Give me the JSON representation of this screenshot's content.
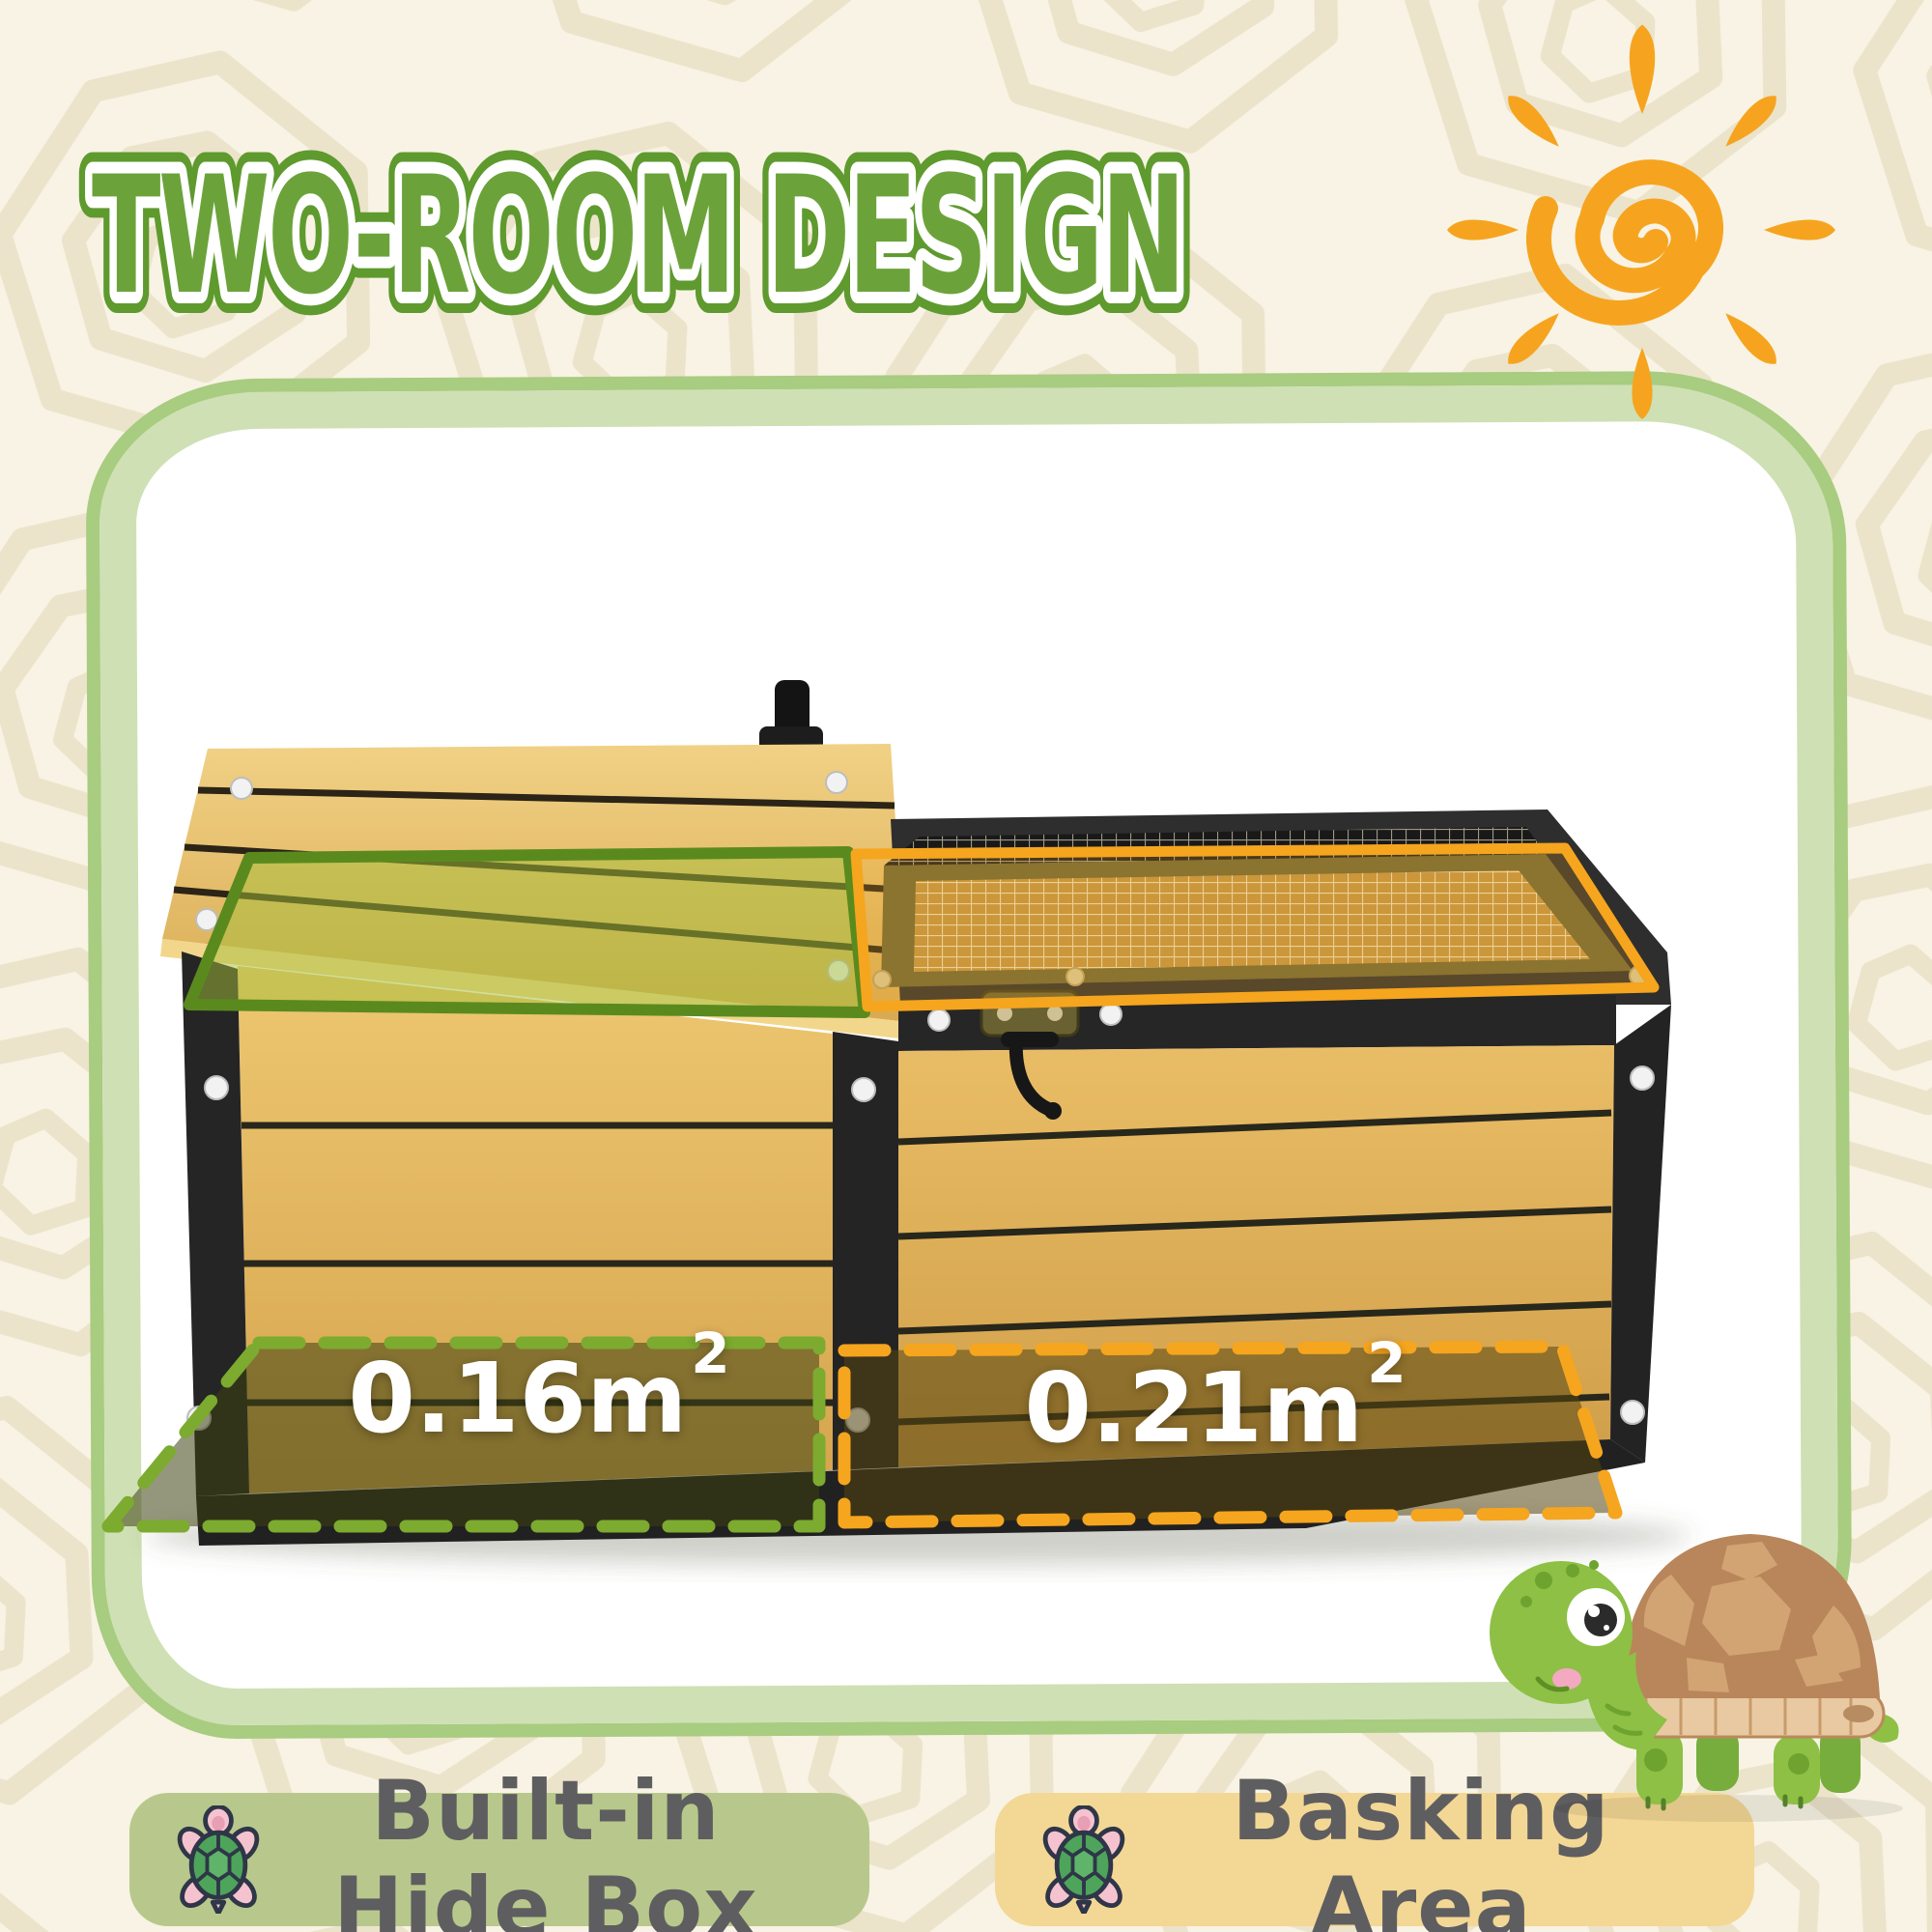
{
  "page": {
    "background": "#f8f3e4",
    "pattern_color": "#ece3cb"
  },
  "title": {
    "text": "TWO-ROOM DESIGN",
    "fill": "#6ba33a",
    "outline": "#5e9a2e"
  },
  "sun": {
    "icon": "sun-spiral-icon",
    "color": "#f6a41f"
  },
  "frame": {
    "band_color": "#cfe0b4",
    "edge_color": "#a8cc80"
  },
  "product": {
    "wood_color": "#e2b35f",
    "metal_color": "#262626",
    "mesh_color": "#c09544",
    "knob_icon": "vent-knob",
    "latch_icon": "lock-latch"
  },
  "areas": {
    "hide_box": {
      "value": "0.16m",
      "sup": "2",
      "outline": "#7cab2f",
      "roof_outline": "#5a8a1e"
    },
    "basking": {
      "value": "0.21m",
      "sup": "2",
      "outline": "#f6a51e"
    }
  },
  "legend": [
    {
      "label": "Built-in Hide Box",
      "background": "#b8c88c",
      "icon": "turtle-icon"
    },
    {
      "label": "Basking Area",
      "background": "#f3d795",
      "icon": "turtle-icon"
    }
  ],
  "mascot": {
    "icon": "turtle-mascot"
  }
}
